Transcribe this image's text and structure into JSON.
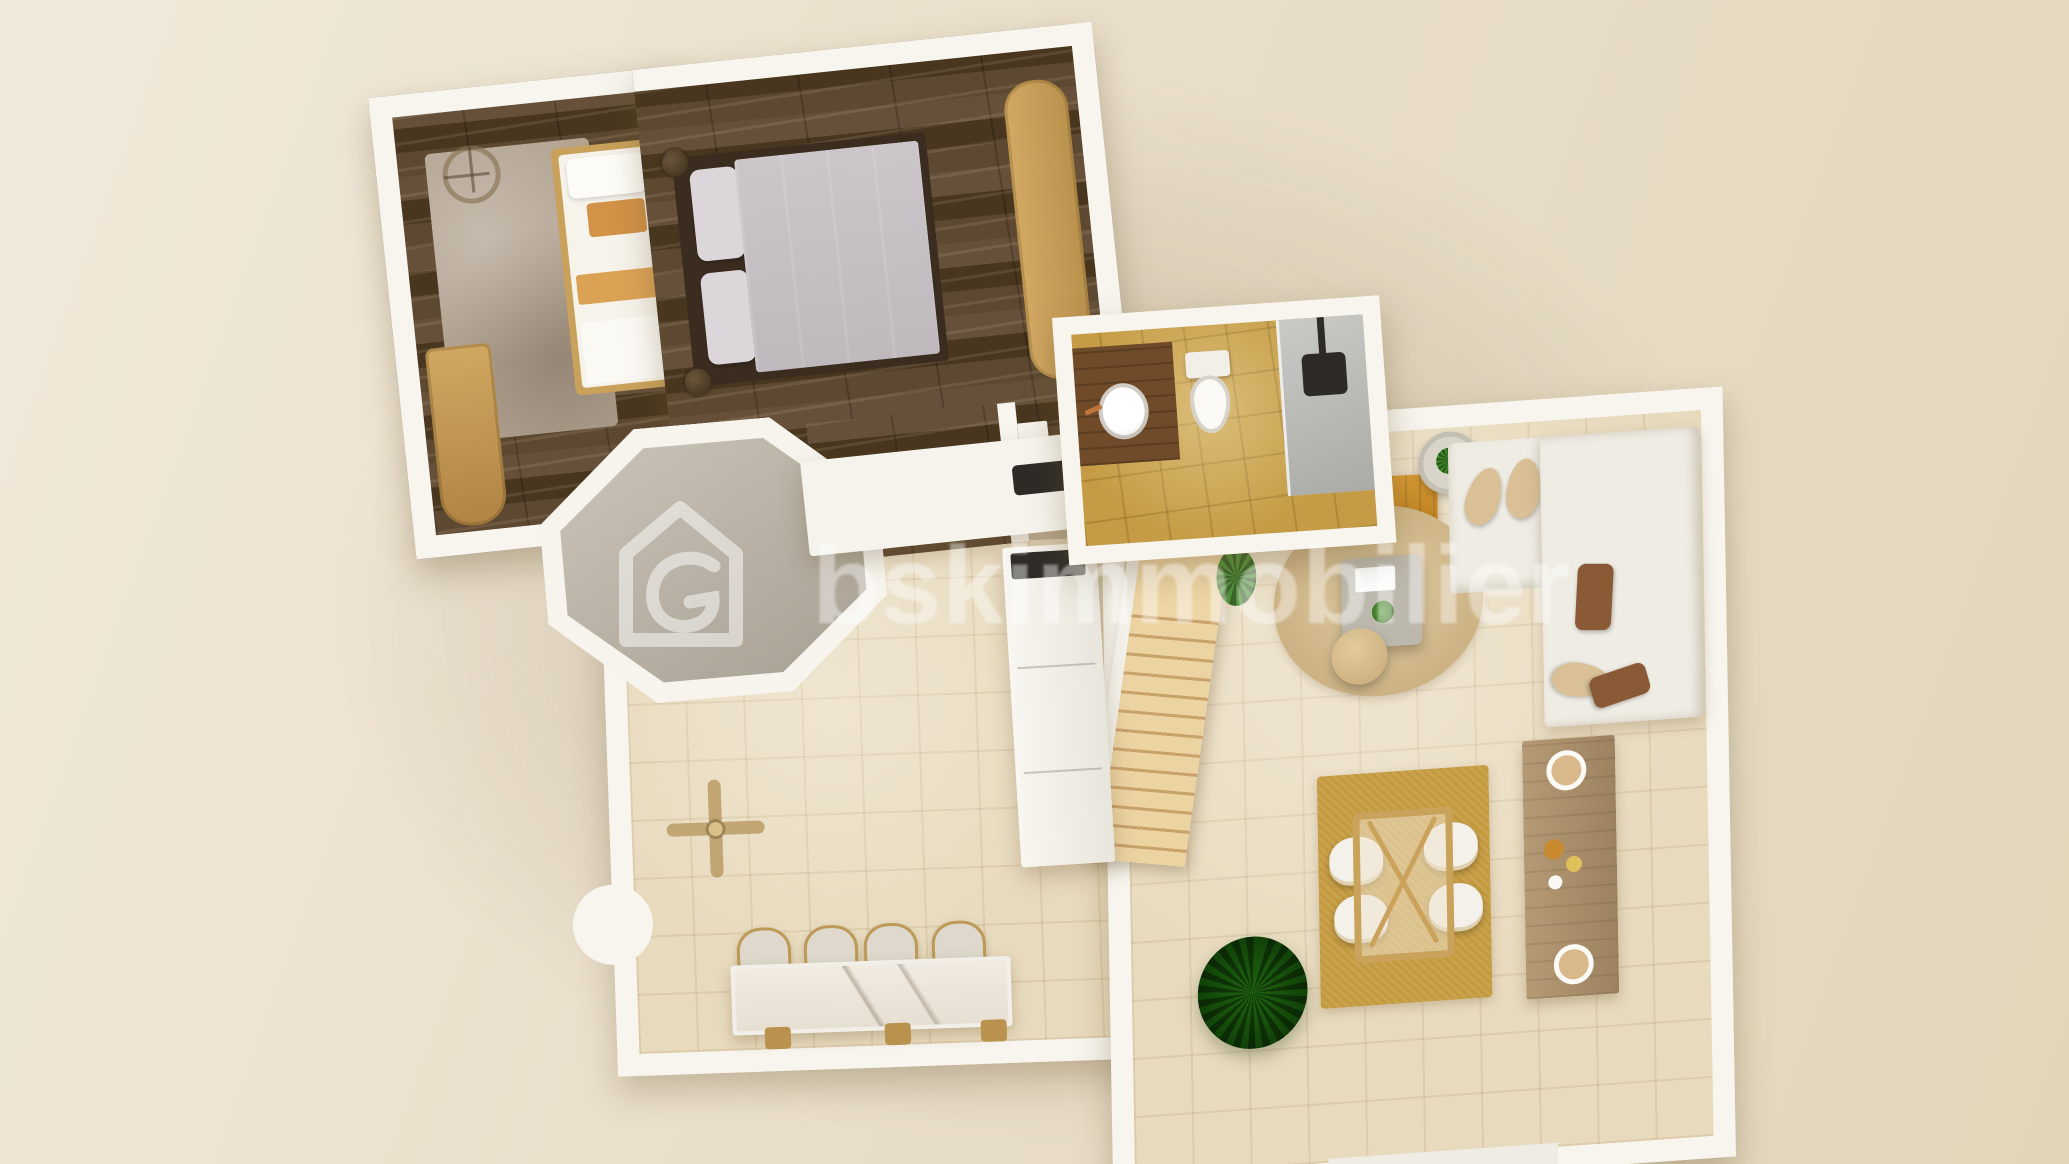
{
  "scene": {
    "type": "3d-floor-plan-render",
    "description": "Top-down 3D rendered floor plan of an apartment on a beige backdrop"
  },
  "watermark": {
    "text": "bskimmobilier",
    "logo_icon": "house-g-logo",
    "color": "#ffffff",
    "opacity": 0.42
  },
  "palette": {
    "background": "#eae0cc",
    "wall": "#f7f5ee",
    "wood_dark": "#54402b",
    "wood_light": "#e5c991",
    "tile_light": "#e8dabd",
    "tile_gold": "#c59c45",
    "turret_floor_gray": "#b5ada1",
    "sofa": "#efece3",
    "rug_gold": "#c49a3f",
    "rug_jute": "#d9c294",
    "rug_bedroom": "#b3a492",
    "plant_green": "#3f8a2b",
    "marble": "#efe9e0",
    "shower_gray": "#b9bcba",
    "showerhead_black": "#2e2b27",
    "vanity_wood": "#6f4b29",
    "accent_orange": "#d29247",
    "bedding_gray": "#c8c2c6"
  },
  "rooms": [
    {
      "id": "bedroom-1",
      "floor": "dark-wood",
      "furniture": [
        "ceiling-fan-light",
        "area-rug",
        "single-bed",
        "wardrobe"
      ]
    },
    {
      "id": "bedroom-2",
      "floor": "dark-wood",
      "furniture": [
        "double-bed",
        "desk-dresser",
        "door-leaf"
      ]
    },
    {
      "id": "bathroom",
      "floor": "gold-tile",
      "furniture": [
        "wood-vanity",
        "round-sink",
        "toilet",
        "walk-in-shower"
      ]
    },
    {
      "id": "turret-room",
      "floor": "gray-screed",
      "furniture": []
    },
    {
      "id": "kitchen-dining",
      "floor": "beige-tile",
      "furniture": [
        "ceiling-fan",
        "marble-island",
        "bar-stools",
        "tall-cabinet",
        "cooktop",
        "counter"
      ]
    },
    {
      "id": "living-room",
      "floor": "beige-tile",
      "furniture": [
        "staircase",
        "wood-console",
        "side-table",
        "l-shaped-sofa",
        "coffee-table",
        "pouf",
        "round-rug",
        "dining-table",
        "dining-chairs",
        "gold-rug",
        "potted-plants",
        "sideboard"
      ]
    }
  ]
}
